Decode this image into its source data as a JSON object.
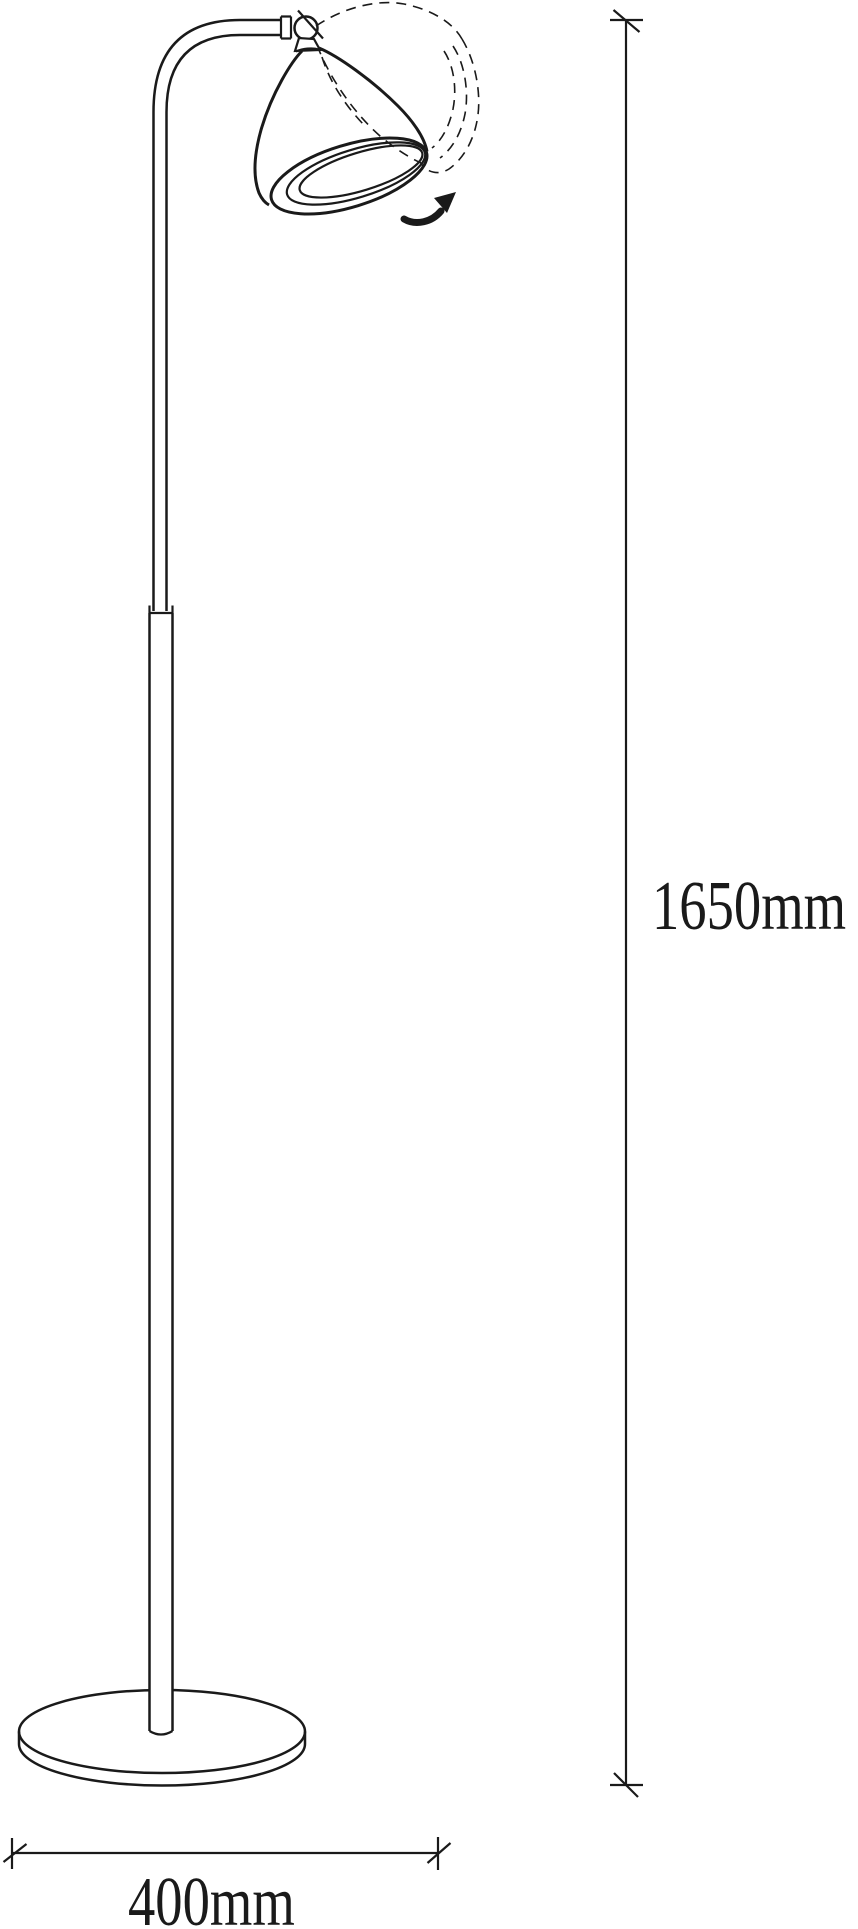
{
  "diagram": {
    "height_label": "1650mm",
    "width_label": "400mm",
    "line_color": "#1a1a1a",
    "background_color": "#ffffff",
    "icons": {
      "rotation_arrow_icon": "curved-arrow-up-right",
      "pivot_screw_icon": "circle-with-slash"
    }
  }
}
